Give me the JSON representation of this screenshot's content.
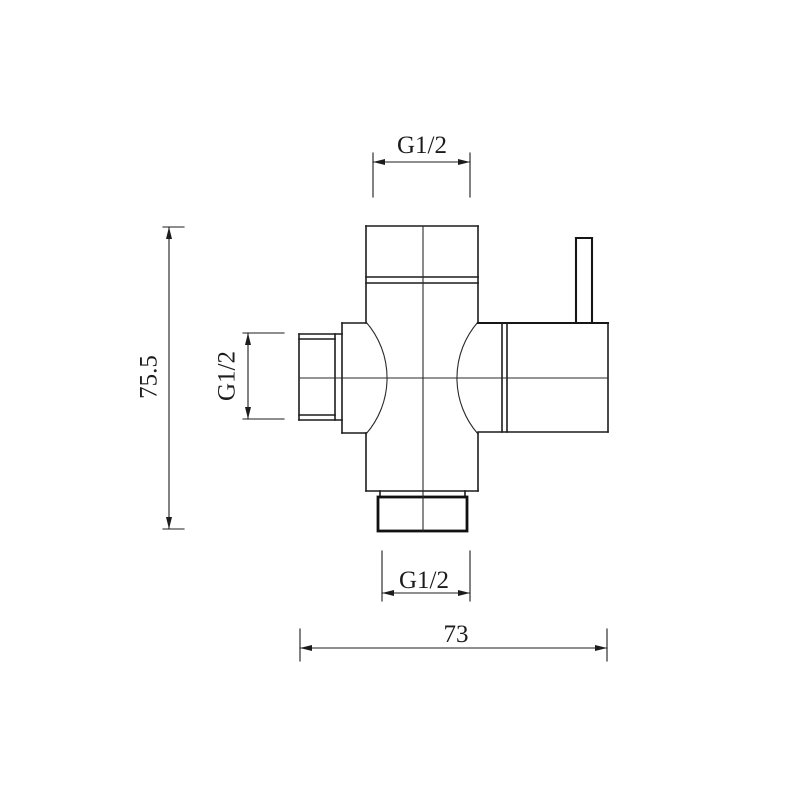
{
  "drawing": {
    "kind": "technical-dimension-drawing",
    "background_color": "#ffffff",
    "line_color": "#1c1c1c",
    "labels": {
      "top_thread": "G1/2",
      "side_thread": "G1/2",
      "bottom_thread": "G1/2",
      "overall_height": "75.5",
      "overall_width": "73"
    }
  }
}
